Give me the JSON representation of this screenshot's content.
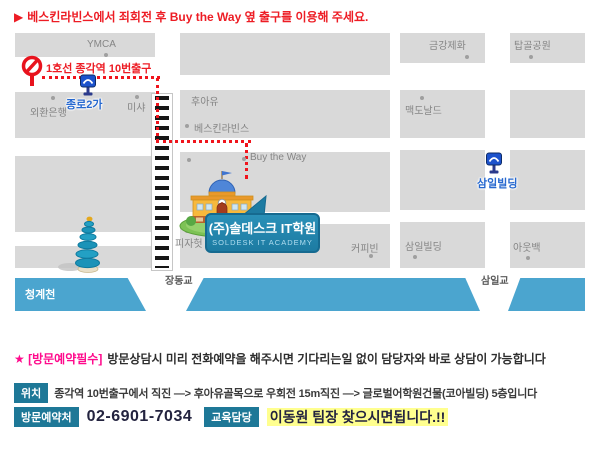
{
  "notice": {
    "arrow": "▶",
    "text": "베스킨라빈스에서 죄회전 후  Buy the Way 옆 출구를 이용해 주세요."
  },
  "map": {
    "blocks": {
      "ymca": "YMCA",
      "geumgang": "금강제화",
      "tapgol": "탑골공원",
      "oehwan": "외환은행",
      "misha": "미샤",
      "whoau": "후아유",
      "baskin": "베스킨라빈스",
      "mcdonalds": "맥도날드",
      "buytheway": "Buy the Way",
      "pizzahut": "피자헛",
      "coffeebean": "커피빈",
      "samil_building": "삼일빌딩",
      "outback": "아웃백"
    },
    "street": {
      "exit_label": "1호선 종각역 10번출구",
      "jongno2ga": "종로2가",
      "samil_station": "삼일빌딩"
    },
    "river": {
      "name": "청계천",
      "bridge_left": "장동교",
      "bridge_right": "삼일교"
    },
    "bubble": {
      "title": "(주)솔데스크 IT학원",
      "subtitle": "SOLDESK IT ACADEMY"
    }
  },
  "footer": {
    "star": "★ [방문예약필수]",
    "star_text": "방문상담시 미리 전화예약을 해주시면 기다리는일 없이 담당자와 바로 상담이 가능합니다",
    "location_badge": "위치",
    "location_text": "종각역 10번출구에서 직진 —> 후아유골목으로 우회전 15m직진 —> 글로벌어학원건물(코아빌딩) 5층입니다",
    "phone_badge": "방문예약처",
    "phone": "02-6901-7034",
    "edu_badge": "교육담당",
    "contact": "이동원 팀장  찾으시면됩니다.!!"
  },
  "colors": {
    "accent_red": "#ed1c24",
    "pink": "#ff0a8c",
    "teal_badge": "#1e7897",
    "river_blue": "#4ba5cf",
    "bubble_teal": "#1d7ba2",
    "block_gray": "#d9d9d9",
    "label_blue": "#2668cf",
    "highlight_yellow": "#ffff8f",
    "phone_dark": "#23233f"
  }
}
